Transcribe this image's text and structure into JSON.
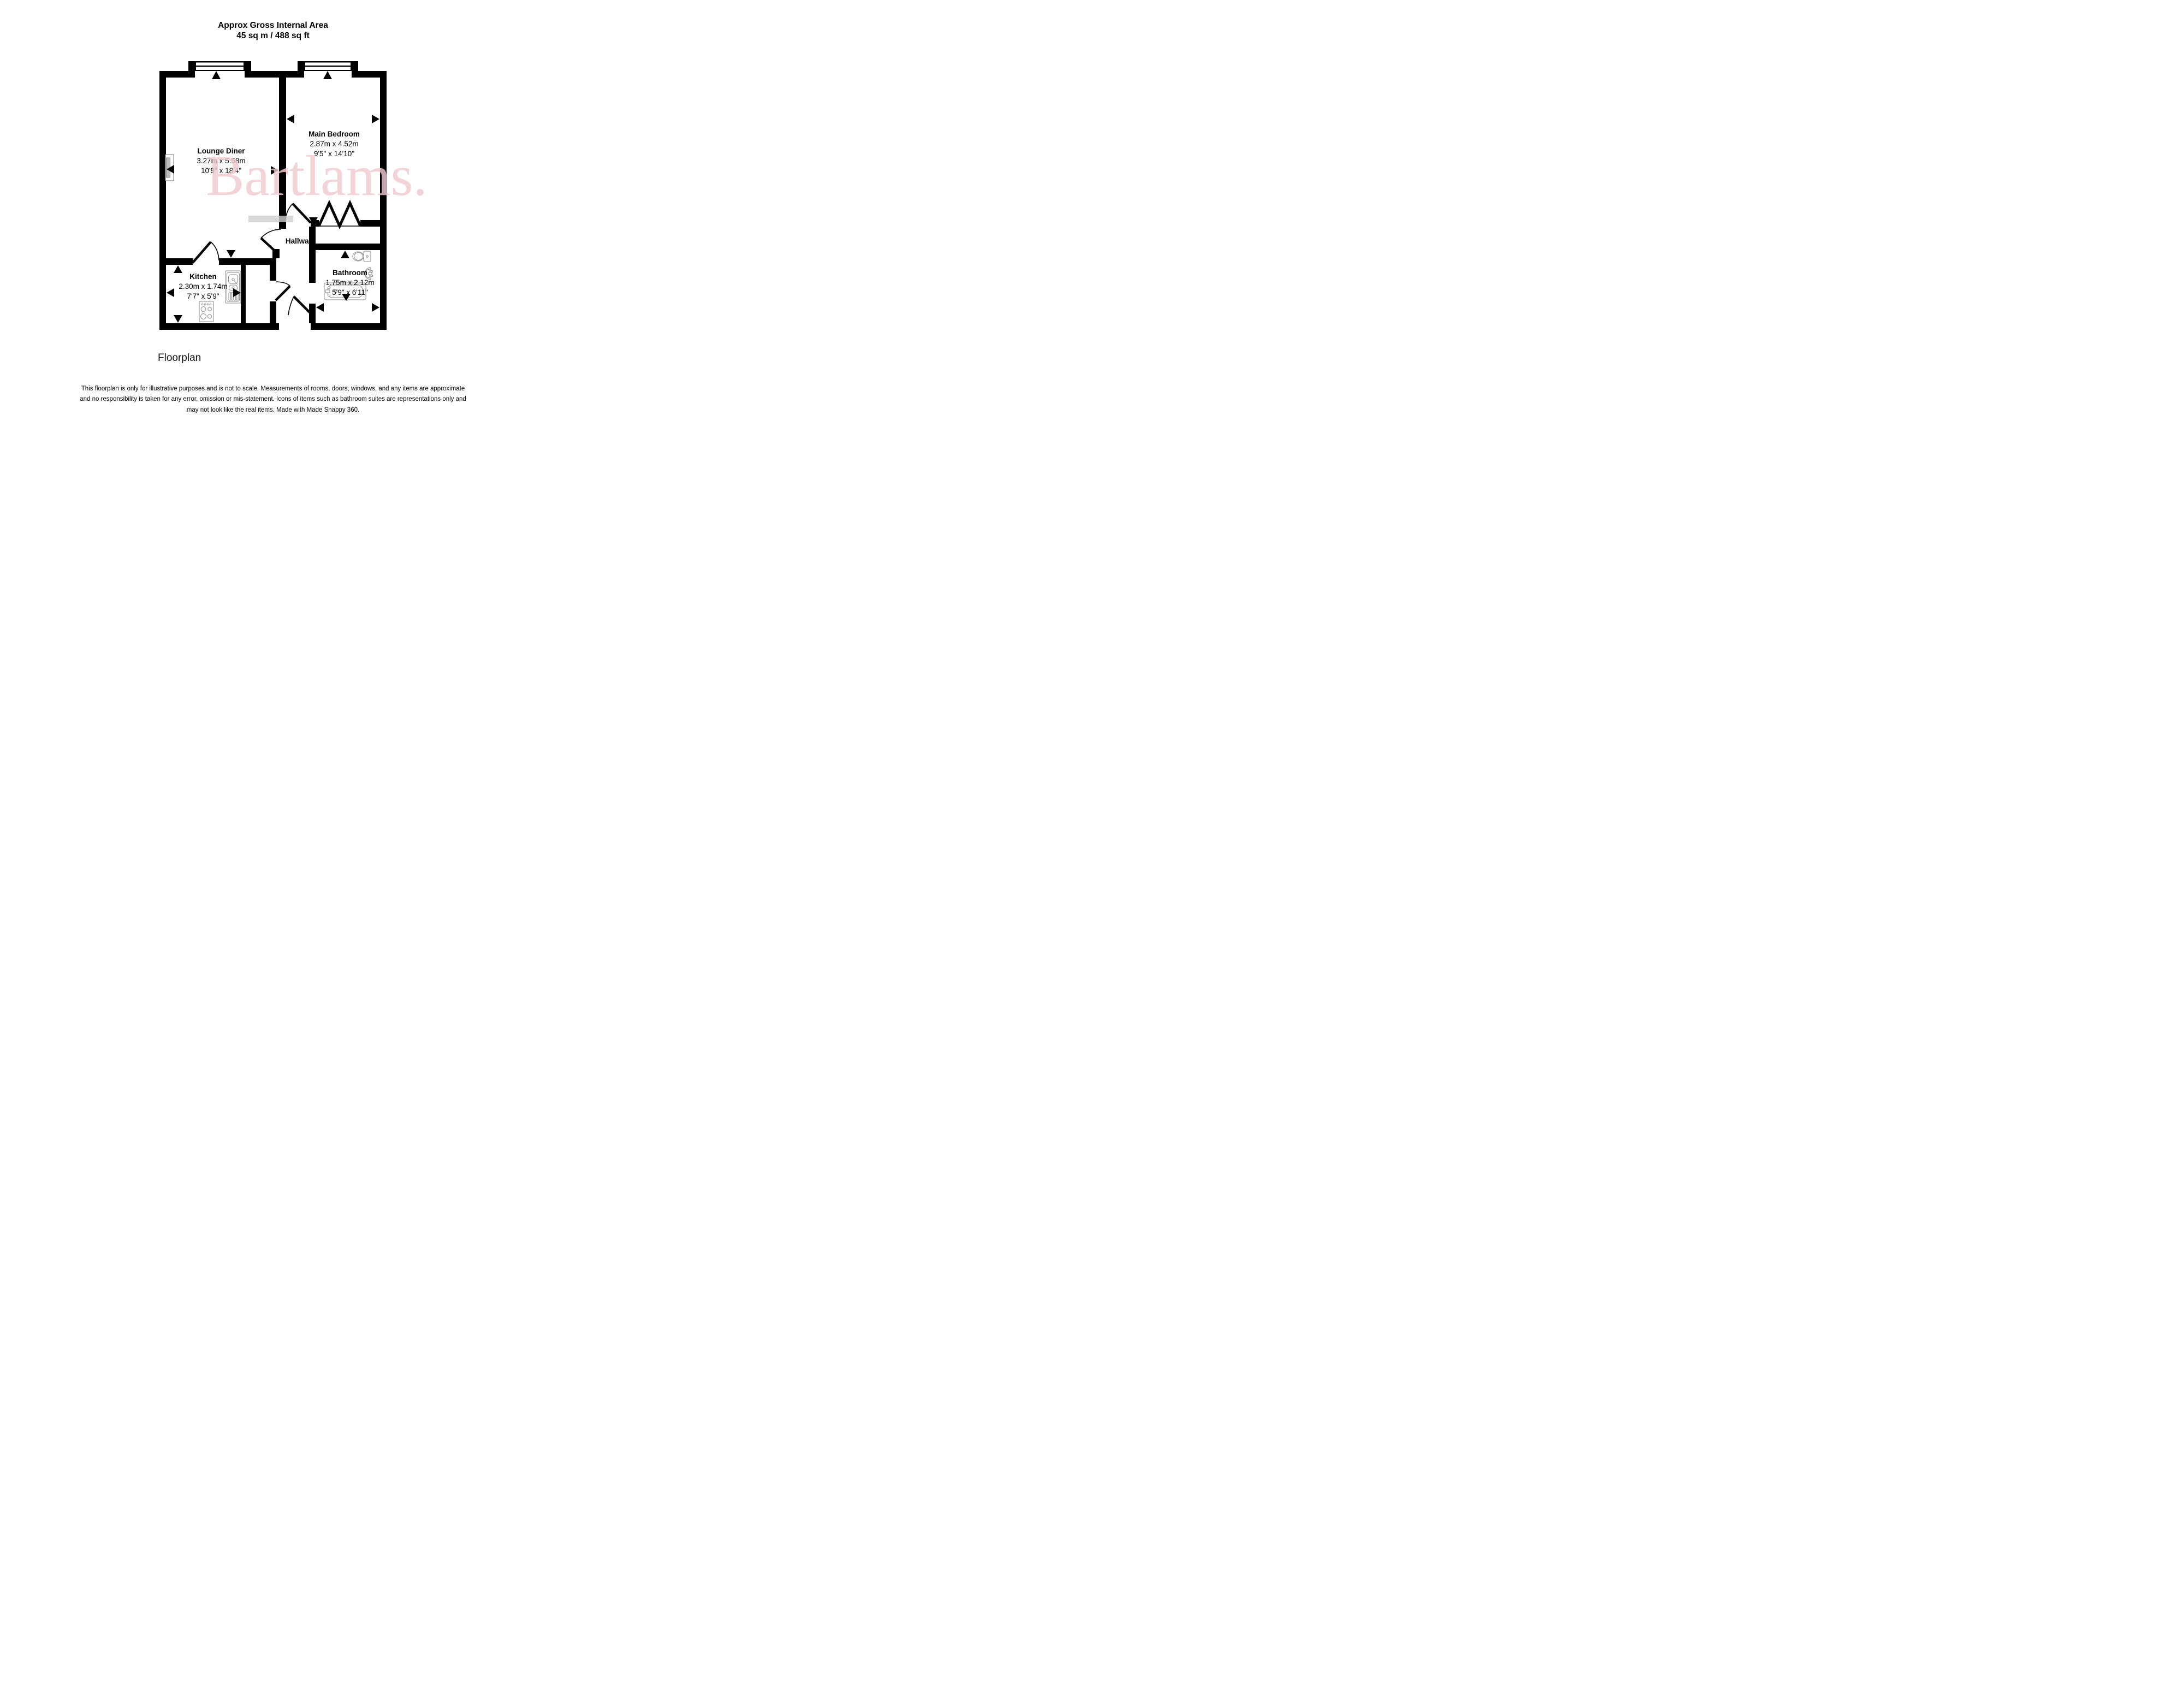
{
  "title": {
    "line1": "Approx Gross Internal Area",
    "line2": "45 sq m / 488 sq ft"
  },
  "watermark": {
    "text": "Bartlams.",
    "color": "#efc9ce"
  },
  "rooms": [
    {
      "name": "Lounge Diner",
      "metric": "3.27m x 5.58m",
      "imperial": "10'9\" x 18'4\""
    },
    {
      "name": "Main Bedroom",
      "metric": "2.87m x 4.52m",
      "imperial": "9'5\" x 14'10\""
    },
    {
      "name": "Kitchen",
      "metric": "2.30m x 1.74m",
      "imperial": "7'7\" x 5'9\""
    },
    {
      "name": "Bathroom",
      "metric": "1.75m x 2.12m",
      "imperial": "5'9\" x 6'11\""
    },
    {
      "name": "Hallway"
    }
  ],
  "footer": {
    "caption": "Floorplan"
  },
  "disclaimer": {
    "lines": [
      "This floorplan is only for illustrative purposes and is not to scale. Measurements of rooms, doors, windows, and any items are approximate",
      "and no responsibility is taken for any error, omission or mis-statement. Icons of items such as bathroom suites are representations only and",
      "may not look like the real items. Made with Made Snappy 360."
    ]
  },
  "colors": {
    "wall": "#000000",
    "fixture_stroke": "#8a8a8a",
    "watermark_pink": "#efc9ce",
    "gray_bar": "#cfcfcf"
  }
}
